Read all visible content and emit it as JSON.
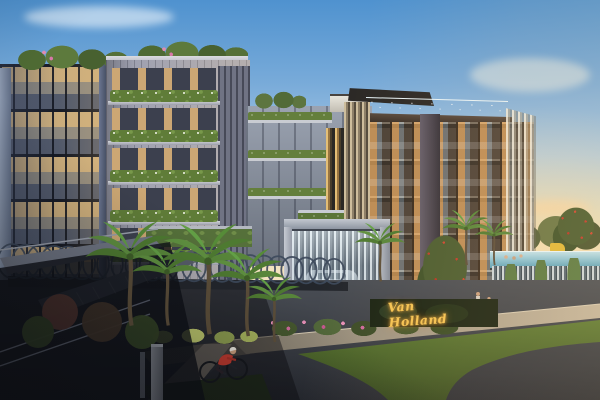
{
  "scene": {
    "type": "architectural-rendering-dusk",
    "signage": {
      "text": "Van Holland"
    },
    "palette": {
      "sky_top": "#4f92cf",
      "sky_horizon": "#f7e6c2",
      "facade_light_gray": "#9fa1b0",
      "facade_bronze": "#51453b",
      "glass_warm": "#e2b677",
      "screen_gold": "#d3a85e",
      "rooftop_pool_blue": "#a8d4e4",
      "lap_pool_blue": "#8fc6d8",
      "waterfall_gray": "#cfdbe2",
      "foliage_green": "#5f7c38",
      "flower_pink": "#e890b8",
      "flower_red": "#c43a2a",
      "road_asphalt": "#383b42",
      "grass_green": "#4a6428",
      "sign_gold": "#f6c453",
      "cyclist_shirt": "#c23a2e",
      "canopy_ring": "#3e4a5c"
    }
  }
}
